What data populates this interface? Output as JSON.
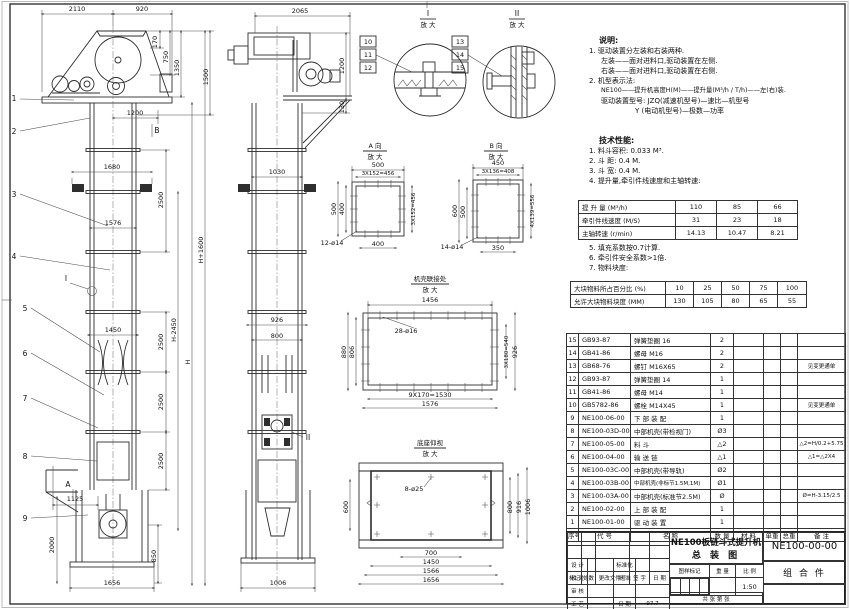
{
  "views": {
    "front": {
      "top_w1": "2110",
      "top_w2": "920",
      "h170": "170",
      "h750": "750",
      "h1350": "1350",
      "h1500": "1500",
      "w1200": "1200",
      "w1680": "1680",
      "w1576": "1576",
      "w1450": "1450",
      "w1125": "1125",
      "w1656": "1656",
      "s2500": "2500",
      "hH": "H",
      "hHm": "H-2450",
      "hHp": "H+1600",
      "h2000": "2000",
      "h850": "850",
      "secA": "A",
      "secB": "B",
      "detI": "I",
      "b1": "1",
      "b2": "2",
      "b3": "3",
      "b4": "4",
      "b5": "5",
      "b6": "6",
      "b7": "7",
      "b8": "8",
      "b9": "9"
    },
    "side": {
      "top": "2065",
      "h1200": "1200",
      "h130": "130",
      "w1030": "1030",
      "w926": "926",
      "w800": "800",
      "w1006": "1006",
      "detII": "II"
    },
    "detail1": {
      "t": "I",
      "mag": "放 大",
      "b10": "10",
      "b11": "11",
      "b12": "12"
    },
    "detail2": {
      "t": "II",
      "mag": "放 大",
      "b13": "13",
      "b14": "14",
      "b15": "15"
    },
    "viewA": {
      "t": "A 向",
      "mag": "放 大",
      "d1": "500",
      "d2": "3X152=456",
      "d3": "500",
      "d4": "400",
      "d5": "3X152=456",
      "d6": "400",
      "holes": "12-ø14"
    },
    "viewB": {
      "t": "B 向",
      "mag": "放 大",
      "d1": "450",
      "d2": "3X136=408",
      "d3": "600",
      "d4": "500",
      "d5": "4X139=556",
      "d6": "350",
      "holes": "14-ø14"
    },
    "shell": {
      "t": "机壳联接处",
      "mag": "放 大",
      "d1": "1456",
      "holes": "28-ø16",
      "d2": "880",
      "d3": "806",
      "d4": "3X180=540",
      "d5": "926",
      "d6": "9X170=1530",
      "d7": "1576"
    },
    "base": {
      "t": "底座仰视",
      "mag": "放 大",
      "holes": "8-ø25",
      "d1": "600",
      "d2": "800",
      "d3": "916",
      "d4": "1006",
      "d5": "700",
      "d6": "1450",
      "d7": "1566",
      "d8": "1656"
    }
  },
  "notes": {
    "heading": "说明:",
    "l1": "1. 驱动装置分左装和右装两种.",
    "l2": "左装——面对进料口,驱动装置在左侧.",
    "l3": "右装——面对进料口,驱动装置在右侧.",
    "l4": "2. 机型表示法:",
    "l5": "NE100——提升机高度H(M)——提升量(M³/h / T/h)——左(右)装.",
    "l6": "驱动装置型号: JZQ(减速机型号)—速比—机型号",
    "l7": "Y (电动机型号)—极数—功率"
  },
  "tech": {
    "heading": "技术性能:",
    "t1": "1. 料斗容积: 0.033 M³.",
    "t2": "2. 斗  距: 0.4 M.",
    "t3": "3. 斗  宽: 0.4 M.",
    "t4": "4. 提升量,牵引件线速度和主轴转速:",
    "t5": "5. 填充系数按0.7计算.",
    "t6": "6. 牵引件安全系数>1倍.",
    "t7": "7. 物料块度:",
    "table1": [
      [
        "提 升 量  (M³/h)",
        "110",
        "85",
        "66"
      ],
      [
        "牵引件线速度 (M/S)",
        "31",
        "23",
        "18"
      ],
      [
        "主轴转速 (r/min)",
        "14.13",
        "10.47",
        "8.21"
      ]
    ],
    "table2": [
      [
        "大块物料所占百分比 (%)",
        "10",
        "25",
        "50",
        "75",
        "100"
      ],
      [
        "允许大块物料块度 (MM)",
        "130",
        "105",
        "80",
        "65",
        "55"
      ]
    ]
  },
  "bom": {
    "headers": [
      "序号",
      "代  号",
      "名  称",
      "数 量",
      "材  料",
      "单重",
      "总重",
      "备  注"
    ],
    "rows": [
      {
        "n": "15",
        "c": "GB93-87",
        "m": "弹簧垫圈  16",
        "q": "2",
        "r": ""
      },
      {
        "n": "14",
        "c": "GB41-86",
        "m": "螺母  M16",
        "q": "2",
        "r": ""
      },
      {
        "n": "13",
        "c": "GB68-76",
        "m": "螺钉  M16X65",
        "q": "2",
        "r": "见变更通单"
      },
      {
        "n": "12",
        "c": "GB93-87",
        "m": "弹簧垫圈  14",
        "q": "1",
        "r": ""
      },
      {
        "n": "11",
        "c": "GB41-86",
        "m": "螺母  M14",
        "q": "1",
        "r": ""
      },
      {
        "n": "10",
        "c": "GB5782-86",
        "m": "螺栓  M14X45",
        "q": "1",
        "r": "见变更通单"
      },
      {
        "n": "9",
        "c": "NE100-06-00",
        "m": "下 部 装 配",
        "q": "1",
        "r": ""
      },
      {
        "n": "8",
        "c": "NE100-03D-00",
        "m": "中部机壳(带检视门)",
        "q": "Ø3",
        "r": ""
      },
      {
        "n": "7",
        "c": "NE100-05-00",
        "m": "料  斗",
        "q": "△2",
        "r": "△2=H/0.2+5.75"
      },
      {
        "n": "6",
        "c": "NE100-04-00",
        "m": "输 送 链",
        "q": "△1",
        "r": "△1=△2X4"
      },
      {
        "n": "5",
        "c": "NE100-03C-00",
        "m": "中部机壳(带导轨)",
        "q": "Ø2",
        "r": ""
      },
      {
        "n": "4",
        "c": "NE100-03B-00",
        "m": "中部机壳(非标节1.5M,1M)",
        "q": "Ø1",
        "r": ""
      },
      {
        "n": "3",
        "c": "NE100-03A-00",
        "m": "中部机壳(标准节2.5M)",
        "q": "Ø",
        "r": "Ø=H-3.15/2.5"
      },
      {
        "n": "2",
        "c": "NE100-02-00",
        "m": "上 部 装 配",
        "q": "1",
        "r": ""
      },
      {
        "n": "1",
        "c": "NE100-01-00",
        "m": "驱 动 装 置",
        "q": "1",
        "r": ""
      }
    ]
  },
  "title_block": {
    "product": "NE100板链斗式提升机",
    "sheet_name": "总  装  图",
    "drawing_no": "NE100-00-00",
    "part_category": "组 合 件",
    "rev_headers": [
      "标记",
      "处数",
      "更改文件号",
      "签 字",
      "日 期"
    ],
    "sig_rows": [
      [
        "设 计",
        "标准化"
      ],
      [
        "校 对",
        "批 准"
      ],
      [
        "审 核",
        ""
      ],
      [
        "工 艺",
        "日 期"
      ]
    ],
    "date": "97.7",
    "stamp_headers": [
      "图样标记",
      "重 量",
      "比 例"
    ],
    "scale": "1:50",
    "sheet_note": "共    张  第    张"
  }
}
